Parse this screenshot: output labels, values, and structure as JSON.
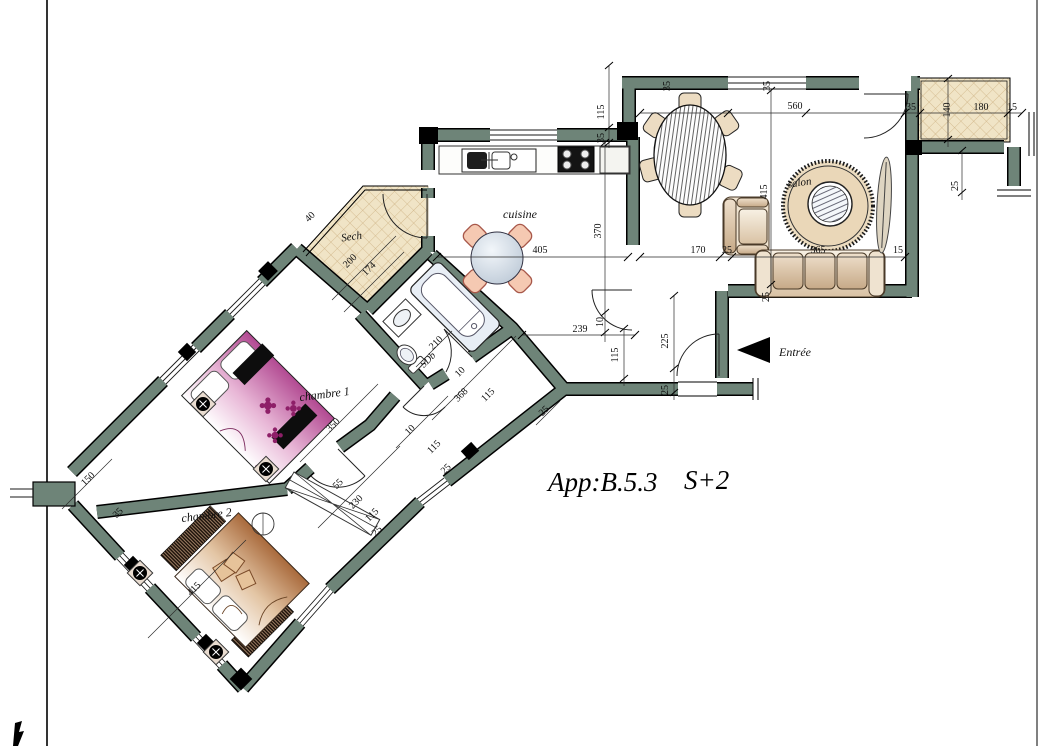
{
  "title": {
    "apartment": "App:B.5.3",
    "type": "S+2"
  },
  "rooms": {
    "kitchen": "cuisine",
    "dryer": "Sech",
    "bathroom": "SDb",
    "bedroom1": "chambre 1",
    "bedroom2": "chambre 2",
    "living": "salon",
    "entrance": "Entrée"
  },
  "colors": {
    "wall": "#6e8478",
    "tile": "#f0e4c6",
    "tile_line": "#cdb183",
    "bed1_accent": "#8e1f68",
    "bed2_accent": "#b97947",
    "chair": "#f5c9b2",
    "fixture": "#e8eef5"
  },
  "dimensions": [
    {
      "v": "115",
      "x": 604,
      "y": 112,
      "r": -90
    },
    {
      "v": "35",
      "x": 670,
      "y": 86,
      "r": -90
    },
    {
      "v": "35",
      "x": 770,
      "y": 86,
      "r": -90
    },
    {
      "v": "560",
      "x": 795,
      "y": 109,
      "r": 0
    },
    {
      "v": "35",
      "x": 911,
      "y": 110,
      "r": 0
    },
    {
      "v": "140",
      "x": 950,
      "y": 110,
      "r": -90
    },
    {
      "v": "180",
      "x": 981,
      "y": 110,
      "r": 0
    },
    {
      "v": "15",
      "x": 1012,
      "y": 110,
      "r": 0
    },
    {
      "v": "25",
      "x": 958,
      "y": 186,
      "r": -90
    },
    {
      "v": "35",
      "x": 604,
      "y": 138,
      "r": -90
    },
    {
      "v": "370",
      "x": 601,
      "y": 231,
      "r": -90
    },
    {
      "v": "405",
      "x": 540,
      "y": 253,
      "r": 0
    },
    {
      "v": "415",
      "x": 767,
      "y": 192,
      "r": -90
    },
    {
      "v": "170",
      "x": 698,
      "y": 253,
      "r": 0
    },
    {
      "v": "25",
      "x": 727,
      "y": 253,
      "r": 0
    },
    {
      "v": "365",
      "x": 818,
      "y": 253,
      "r": 0
    },
    {
      "v": "15",
      "x": 898,
      "y": 253,
      "r": 0
    },
    {
      "v": "225",
      "x": 668,
      "y": 341,
      "r": -90
    },
    {
      "v": "25",
      "x": 668,
      "y": 390,
      "r": -90
    },
    {
      "v": "25",
      "x": 769,
      "y": 297,
      "r": -90
    },
    {
      "v": "239",
      "x": 580,
      "y": 332,
      "r": 0
    },
    {
      "v": "115",
      "x": 618,
      "y": 355,
      "r": -90
    },
    {
      "v": "10",
      "x": 603,
      "y": 322,
      "r": -90
    },
    {
      "v": "40",
      "x": 312,
      "y": 219,
      "r": -45
    },
    {
      "v": "200",
      "x": 352,
      "y": 263,
      "r": -45
    },
    {
      "v": "174",
      "x": 371,
      "y": 271,
      "r": -45
    },
    {
      "v": "210",
      "x": 438,
      "y": 345,
      "r": -45
    },
    {
      "v": "10",
      "x": 462,
      "y": 374,
      "r": -45
    },
    {
      "v": "368",
      "x": 463,
      "y": 397,
      "r": -45
    },
    {
      "v": "115",
      "x": 490,
      "y": 397,
      "r": -45
    },
    {
      "v": "350",
      "x": 335,
      "y": 427,
      "r": -45
    },
    {
      "v": "150",
      "x": 90,
      "y": 481,
      "r": -45
    },
    {
      "v": "35",
      "x": 120,
      "y": 515,
      "r": -45
    },
    {
      "v": "415",
      "x": 196,
      "y": 591,
      "r": -45
    },
    {
      "v": "10",
      "x": 412,
      "y": 432,
      "r": -45
    },
    {
      "v": "115",
      "x": 436,
      "y": 449,
      "r": -45
    },
    {
      "v": "25",
      "x": 448,
      "y": 471,
      "r": -45
    },
    {
      "v": "55",
      "x": 340,
      "y": 486,
      "r": -45
    },
    {
      "v": "230",
      "x": 358,
      "y": 504,
      "r": -45
    },
    {
      "v": "115",
      "x": 374,
      "y": 517,
      "r": -45
    },
    {
      "v": "25",
      "x": 379,
      "y": 533,
      "r": -45
    },
    {
      "v": "25",
      "x": 546,
      "y": 413,
      "r": -45
    }
  ]
}
